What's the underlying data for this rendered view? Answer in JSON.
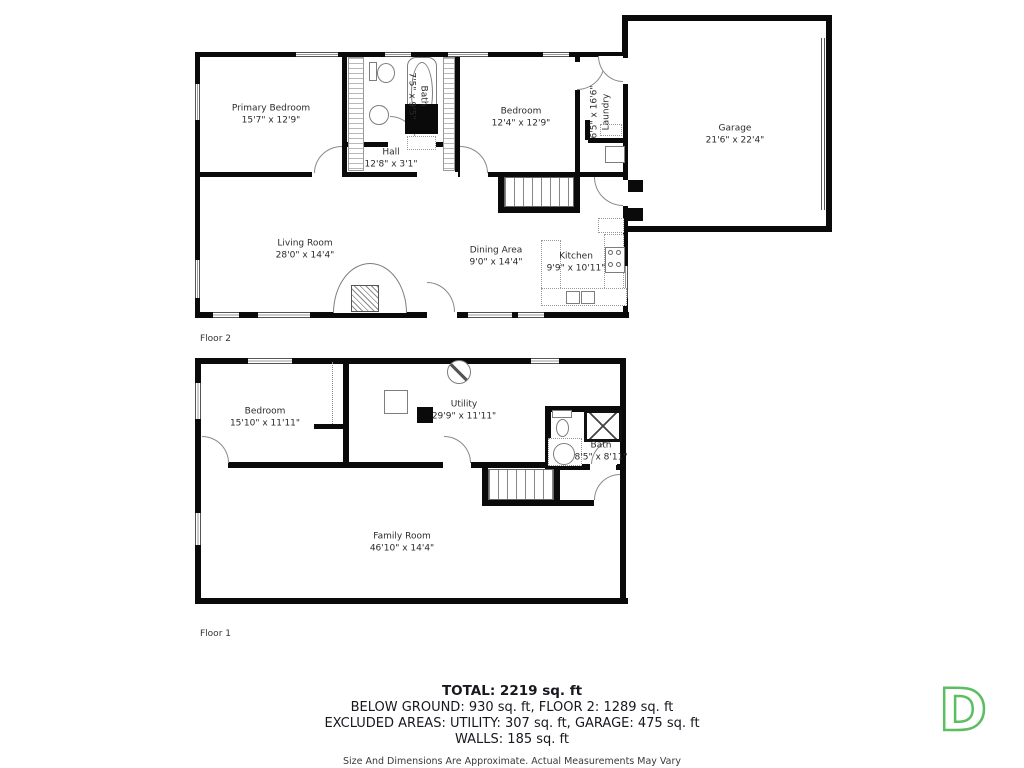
{
  "floor2": {
    "label": "Floor 2",
    "rooms": {
      "primary_bedroom": {
        "name": "Primary Bedroom",
        "dims": "15'7\" x 12'9\""
      },
      "bath": {
        "name": "Bath",
        "dims": "7'5\" x 9'5\""
      },
      "hall": {
        "name": "Hall",
        "dims": "12'8\" x 3'1\""
      },
      "bedroom": {
        "name": "Bedroom",
        "dims": "12'4\" x 12'9\""
      },
      "laundry": {
        "name": "Laundry",
        "dims": "6'5\" x 16'6\""
      },
      "garage": {
        "name": "Garage",
        "dims": "21'6\" x 22'4\""
      },
      "living_room": {
        "name": "Living Room",
        "dims": "28'0\" x 14'4\""
      },
      "dining_area": {
        "name": "Dining Area",
        "dims": "9'0\" x 14'4\""
      },
      "kitchen": {
        "name": "Kitchen",
        "dims": "9'9\" x 10'11\""
      }
    }
  },
  "floor1": {
    "label": "Floor 1",
    "rooms": {
      "bedroom": {
        "name": "Bedroom",
        "dims": "15'10\" x 11'11\""
      },
      "utility": {
        "name": "Utility",
        "dims": "29'9\" x 11'11\""
      },
      "bath": {
        "name": "Bath",
        "dims": "8'5\" x 8'11\""
      },
      "family_room": {
        "name": "Family Room",
        "dims": "46'10\" x 14'4\""
      }
    }
  },
  "summary": {
    "total": "TOTAL: 2219 sq. ft",
    "below_ground_line": "BELOW GROUND: 930 sq. ft, FLOOR 2: 1289 sq. ft",
    "excluded_line": "EXCLUDED AREAS: UTILITY: 307 sq. ft, GARAGE: 475 sq. ft",
    "walls_line": "WALLS: 185 sq. ft",
    "disclaimer": "Size And Dimensions Are Approximate. Actual Measurements May Vary"
  },
  "logo": {
    "letter": "D",
    "color": "#5CBE63"
  }
}
